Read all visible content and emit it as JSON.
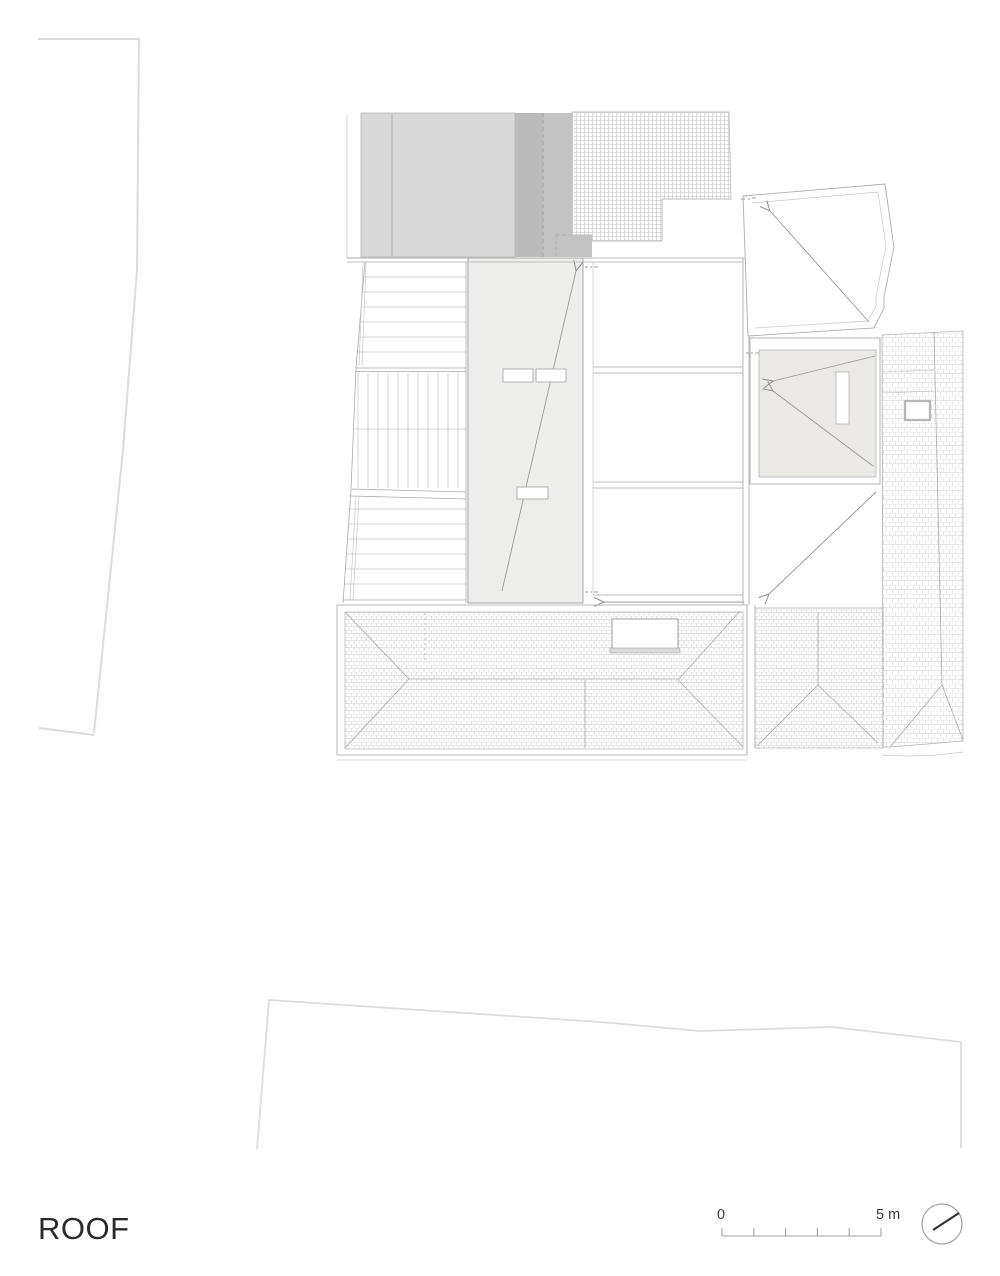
{
  "title": {
    "label": "ROOF"
  },
  "scale_bar": {
    "zero_label": "0",
    "max_label": "5 m",
    "tick_count": 6,
    "length_meters": 5
  },
  "north_indicator": {
    "icon": "north-compass-icon"
  },
  "colors": {
    "background": "#ffffff",
    "site_line": "#dcdcdc",
    "plan_line": "#a9a9a9",
    "building_gray_light": "#d8d8d8",
    "building_gray_dark": "#bababa",
    "building_gray_mid": "#c3c3c3",
    "strip_fill": "#ededeb",
    "terrace_fill": "#ebe9e6",
    "text_color": "#2b2b2b"
  }
}
